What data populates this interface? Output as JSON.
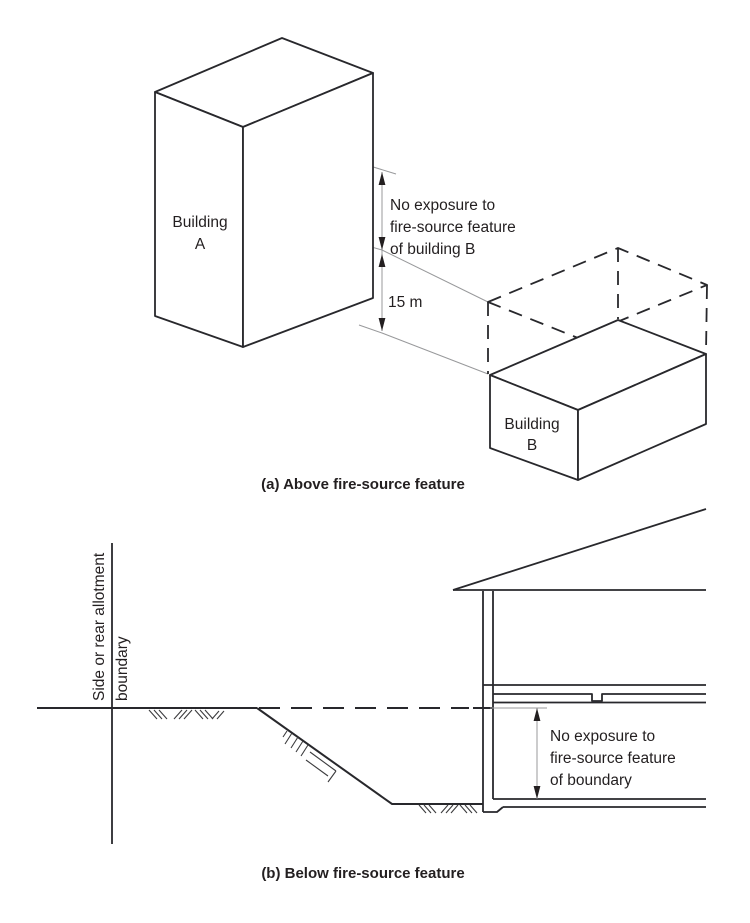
{
  "colors": {
    "background": "#ffffff",
    "main_line": "#28282c",
    "thin_line": "#98999b",
    "text": "#231f20"
  },
  "figure_a": {
    "caption": "(a) Above fire-source feature",
    "building_a": [
      "Building",
      "A"
    ],
    "building_b": [
      "Building",
      "B"
    ],
    "annotation": [
      "No exposure to",
      "fire-source feature",
      "of building B"
    ],
    "dimension_label": "15 m"
  },
  "figure_b": {
    "caption": "(b) Below fire-source feature",
    "boundary_label": [
      "Side or rear allotment",
      "boundary"
    ],
    "annotation": [
      "No exposure to",
      "fire-source feature",
      "of boundary"
    ]
  }
}
